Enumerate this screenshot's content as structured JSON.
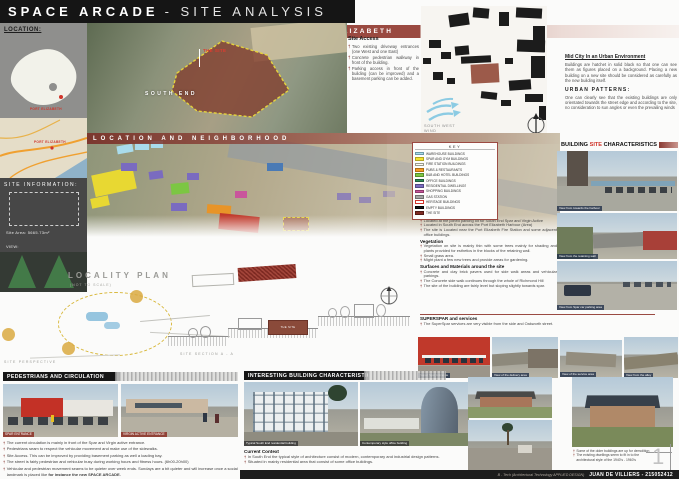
{
  "colors": {
    "accent_maroon": "#9a4a41",
    "header_black": "#151515",
    "site_brown": "#7e2a22",
    "highlight_red": "#d0342a",
    "wind_blue": "#8ccbe3"
  },
  "header": {
    "title_main": "SPACE ARCADE",
    "title_sub": "- SITE ANALYSIS"
  },
  "banner": {
    "label": "SOUTH END, PORT ELIZABETH"
  },
  "location_panel": {
    "label": "LOCATION:",
    "city": "PORT ELIZABETH"
  },
  "road_map": {
    "city": "PORT ELIZABETH"
  },
  "site_info": {
    "title": "SITE INFORMATION:",
    "area": "Site Area: 5665.73m²",
    "view_label": "VIEW:"
  },
  "aerial": {
    "site_label": "THE SITE",
    "district_label": "SOUTH END"
  },
  "site_access": {
    "heading": "Site Access",
    "bullets": [
      "Two existing driveway entrances (one West and one East)",
      "Concrete pedestrian walkway in front of the building.",
      "Parking access in front of the building (can be improved) and a basement parking can be added."
    ]
  },
  "figure_ground": {
    "wind_label_line1": "SOUTH WEST",
    "wind_label_line2": "WIND"
  },
  "mid_city": {
    "heading": "Mid City In an Urban Environment",
    "body": "Buildings are hatchet in solid black so that one can see them as figures placed on a background. Placing a new building on a new site should be considered as carefully as the new building itself.",
    "patterns_heading": "URBAN PATTERNS:",
    "patterns_body": "One can clearly see that the existing buildings are only orientated towards the street edge and according to the site, no consideration to sun angles or even the prevailing winds"
  },
  "neighborhood": {
    "banner": "LOCATION AND NEIGHBORHOOD"
  },
  "key": {
    "title": "KEY",
    "items": [
      {
        "label": "WAREHOUSE BUILDINGS",
        "bg": "#a9dcec",
        "bd": "#6d9aa8"
      },
      {
        "label": "SPAR AND GYM BUILDINGS",
        "bg": "#f2e230",
        "bd": "#b3a51f"
      },
      {
        "label": "FIRE STATION BUILDINGS",
        "bg": "#fdfdf4",
        "bd": "#9a9a8c"
      },
      {
        "label": "PUBS & RESTAURANTS",
        "bg": "#f59b23",
        "bd": "#b06f14"
      },
      {
        "label": "B&B AND HOTEL BUILDINGS",
        "bg": "#7cc643",
        "bd": "#568c2c"
      },
      {
        "label": "OFFICE BUILDINGS",
        "bg": "#2e8b57",
        "bd": "#1d5c39"
      },
      {
        "label": "RESIDENTIAL DWELLINGS",
        "bg": "#7a6bc0",
        "bd": "#544a87"
      },
      {
        "label": "SHOPPING BUILDINGS",
        "bg": "#c9559c",
        "bd": "#8e3a6d"
      },
      {
        "label": "GAS STATION",
        "bg": "#a3a3a3",
        "bd": "#6f6f6f"
      },
      {
        "label": "HERITAGE BUILDINGS",
        "bg": "#ffffff",
        "bd": "#d0342a"
      },
      {
        "label": "EMPTY BUILDINGS",
        "bg": "#161616",
        "bd": "#000000"
      },
      {
        "label": "THE SITE",
        "bg": "#7e2a22",
        "bd": "#521a14"
      }
    ]
  },
  "building_site": {
    "heading_pre": "BUILDING ",
    "heading_site": "SITE",
    "heading_post": " CHARACTERISTICS",
    "photo_captions": [
      "View from towards the harbour",
      "View from the retaining wall",
      "View from Spar car parking area"
    ]
  },
  "site_notes": {
    "site_heading": "The Site",
    "site_bullets": [
      "Located at the joined parking lot for South End Spar and Virgin Active",
      "Located in South End across the Port Elizabeth Harbour (Area)",
      "The site is Located near the Port Elizabeth Fire Station and some adjacent office buildings."
    ],
    "vegetation_heading": "Vegetation",
    "vegetation_bullets": [
      "Vegetation on site is mainly thin with some trees mainly for shading and plants provided for esthetics in the blocks of the retaining wall.",
      "Small grass area.",
      "Might plant a few new trees and provide areas for gardening."
    ],
    "surfaces_heading": "Surfaces and Materials around the site",
    "surfaces_bullets": [
      "Concrete and clay brick pavers used for side walk areas and vehicular parkings.",
      "The Concrete side walk continues through the whole of Richmond Hill",
      "The site of the building are fairly level but sloping slightly towards spar."
    ],
    "superspar_heading": "SUPERSPAR and services",
    "superspar_bullets": [
      "The SuperSpar services are very visible from the side and Oakworth street."
    ]
  },
  "superspar_strip": {
    "captions": [
      "Super Spar Entrance",
      "View of the delivery area",
      "View of the service area",
      "View from the alley"
    ]
  },
  "locality": {
    "title": "LOCALITY PLAN",
    "subtitle": "(NOT TO SCALE)",
    "perspective_label": "SITE PERSPECTIVE",
    "section_label": "SITE SECTION A - A",
    "site_box_label": "THE SITE"
  },
  "pedestrians": {
    "heading": "PEDESTRIANS AND CIRCULATION",
    "photo_captions": [
      "SPAR ENTRANCE",
      "VIRGIN ACTIVE ENTRANCE"
    ],
    "bullets": [
      "The current circulation is mainly in front of the Spar and Virgin active entrance.",
      "Pedestrians seam to respect the vehicular movement and make use of the sidewalks.",
      "Site Access. This can be improved by providing basement parking as well a loading bay.",
      "The street is fairly pedestrian and vehicular busy during working hours and fitness hours. (6h00-20h00)"
    ],
    "last_bullet": "Vehicular and pedestrian movement seams to be quieter over week ends. Sundays are a bit quieter and will increase once a social landmark is placed like ",
    "last_bullet_bold": "for instance the new SPACE ARCADE."
  },
  "interesting": {
    "heading": "INTERESTING BUILDING CHARACTERISTICS",
    "photo_captions": [
      "Typical South End residential building",
      "Contemporary style office building"
    ],
    "context_heading": "Current Context",
    "bullets": [
      "In South End the typical style of architecture consist of modern, contemporary and industrial design patterns.",
      "Situated in mainly residential area that consist of some office buildings."
    ]
  },
  "older_buildings": {
    "bullets": [
      "Some of the older buildings are up for demolition",
      "The existing dwellings seem to fit in to the architectural style of the 1940's - 1960's"
    ]
  },
  "footer": {
    "program": "B - Tech (Architectural Technology APPLIED DESIGN)",
    "name": "JUAN DE VILLIERS - 215052412"
  },
  "page_number": "1"
}
